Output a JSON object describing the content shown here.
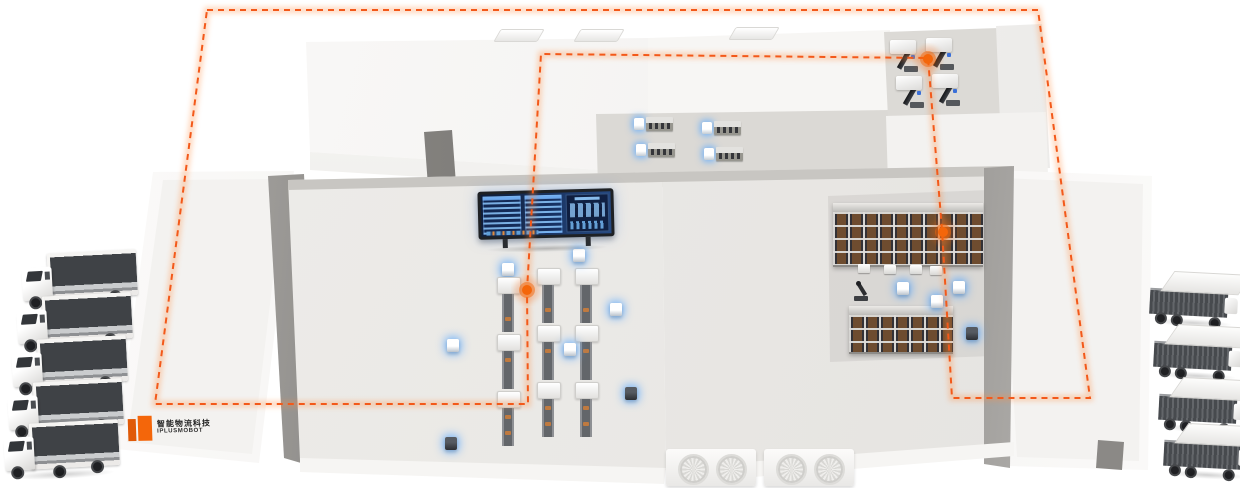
{
  "canvas": {
    "width": 1240,
    "height": 488
  },
  "brand": {
    "line1": "智能物流科技",
    "line2": "IPLUSMOBOT"
  },
  "colors": {
    "route": "#f3591a",
    "route_glow": "#ff8a3c",
    "node": "#f4660a",
    "agv_glow": "rgba(88,168,255,0.8)",
    "logo_orange": "#f4660a",
    "floor": "#ebe9e6",
    "floor_recess": "#d9d7d3",
    "screen_frame": "#1e2125",
    "screen_blue": "#1c3868",
    "rack_box": "#6e4c2f",
    "truck_top": "#3f4246",
    "trailer_side": "#474a4e"
  },
  "route": {
    "loop": [
      [
        207,
        10
      ],
      [
        1038,
        10
      ],
      [
        1090,
        398
      ],
      [
        952,
        398
      ],
      [
        942,
        230
      ],
      [
        928,
        58
      ],
      [
        541,
        54
      ],
      [
        527,
        290
      ],
      [
        528,
        404
      ],
      [
        155,
        404
      ]
    ],
    "nodes": [
      [
        527,
        290
      ],
      [
        928,
        59
      ],
      [
        943,
        232
      ]
    ]
  },
  "left_dock": {
    "trucks": [
      [
        20,
        252
      ],
      [
        15,
        295
      ],
      [
        10,
        338
      ],
      [
        6,
        381
      ],
      [
        2,
        422
      ]
    ]
  },
  "right_dock": {
    "trailers": [
      [
        1150,
        272
      ],
      [
        1154,
        325
      ],
      [
        1159,
        378
      ],
      [
        1164,
        424
      ]
    ]
  },
  "production_lines": [
    {
      "x": 508,
      "y": 263,
      "head": true
    },
    {
      "x": 548,
      "y": 268,
      "head": false
    },
    {
      "x": 586,
      "y": 268,
      "head": false
    }
  ],
  "line_pattern": [
    "machine",
    "conveyor",
    "machine",
    "conveyor",
    "machine",
    "conveyor"
  ],
  "agvs": [
    {
      "x": 573,
      "y": 249,
      "dark": false
    },
    {
      "x": 610,
      "y": 303,
      "dark": false
    },
    {
      "x": 564,
      "y": 343,
      "dark": false
    },
    {
      "x": 447,
      "y": 339,
      "dark": false
    },
    {
      "x": 931,
      "y": 295,
      "dark": false
    },
    {
      "x": 953,
      "y": 281,
      "dark": false
    },
    {
      "x": 897,
      "y": 282,
      "dark": false
    },
    {
      "x": 625,
      "y": 387,
      "dark": true
    },
    {
      "x": 445,
      "y": 437,
      "dark": true
    },
    {
      "x": 966,
      "y": 327,
      "dark": true
    }
  ],
  "annex_stations": [
    [
      634,
      117
    ],
    [
      636,
      143
    ],
    [
      702,
      121
    ],
    [
      704,
      147
    ]
  ],
  "machine_room_machines": [
    [
      890,
      40
    ],
    [
      926,
      38
    ],
    [
      896,
      76
    ],
    [
      932,
      74
    ]
  ],
  "racks": {
    "row1": {
      "x": 833,
      "y": 203,
      "w": 150,
      "h": 62
    },
    "row2": {
      "x": 849,
      "y": 306,
      "w": 104,
      "h": 46
    },
    "carts": [
      [
        858,
        264
      ],
      [
        884,
        265
      ],
      [
        910,
        265
      ],
      [
        930,
        266
      ]
    ]
  },
  "robot_arm": {
    "x": 852,
    "y": 281
  },
  "hvac_units": [
    {
      "x": 666,
      "y": 449
    },
    {
      "x": 764,
      "y": 449
    }
  ],
  "roof_vents": [
    [
      497,
      29
    ],
    [
      577,
      29
    ],
    [
      732,
      27
    ]
  ]
}
